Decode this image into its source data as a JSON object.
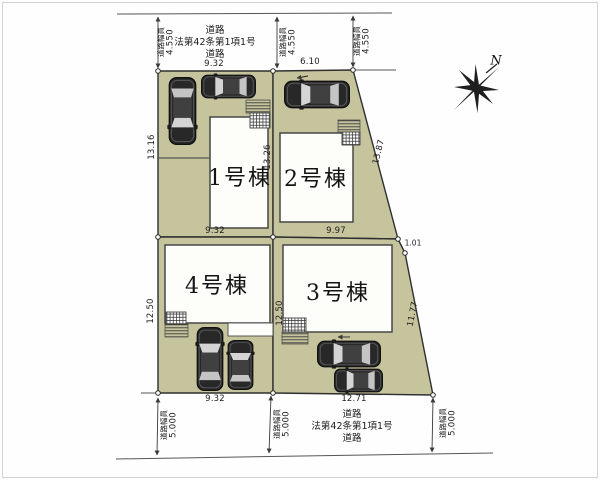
{
  "plan": {
    "lots": [
      {
        "label": "1号棟"
      },
      {
        "label": "2号棟"
      },
      {
        "label": "3号棟"
      },
      {
        "label": "4号棟"
      }
    ],
    "roads": {
      "top": {
        "width_label": "道路幅員",
        "width_value": "4.550",
        "line1": "道路",
        "line2": "法第42条第1項1号",
        "line3": "道路"
      },
      "bottom": {
        "width_label": "道路幅員",
        "width_value": "5.000",
        "line1": "道路",
        "line2": "法第42条第1項1号",
        "line3": "道路"
      }
    },
    "dims": {
      "top_1": "9.32",
      "top_2": "6.10",
      "left_upper": "13.16",
      "left_lower": "12.50",
      "center_upper": "13.26",
      "center_lower": "12.50",
      "slant_upper": "13.87",
      "slant_jog": "1.01",
      "slant_lower": "11.77",
      "mid_1": "9.32",
      "mid_2": "9.97",
      "bottom_1": "9.32",
      "bottom_2": "12.71"
    },
    "compass": {
      "north": "N"
    },
    "colors": {
      "lot_fill": "#c6c49c",
      "boundary_line": "#2f2f2f",
      "building_fill": "#fdfdfa"
    }
  }
}
